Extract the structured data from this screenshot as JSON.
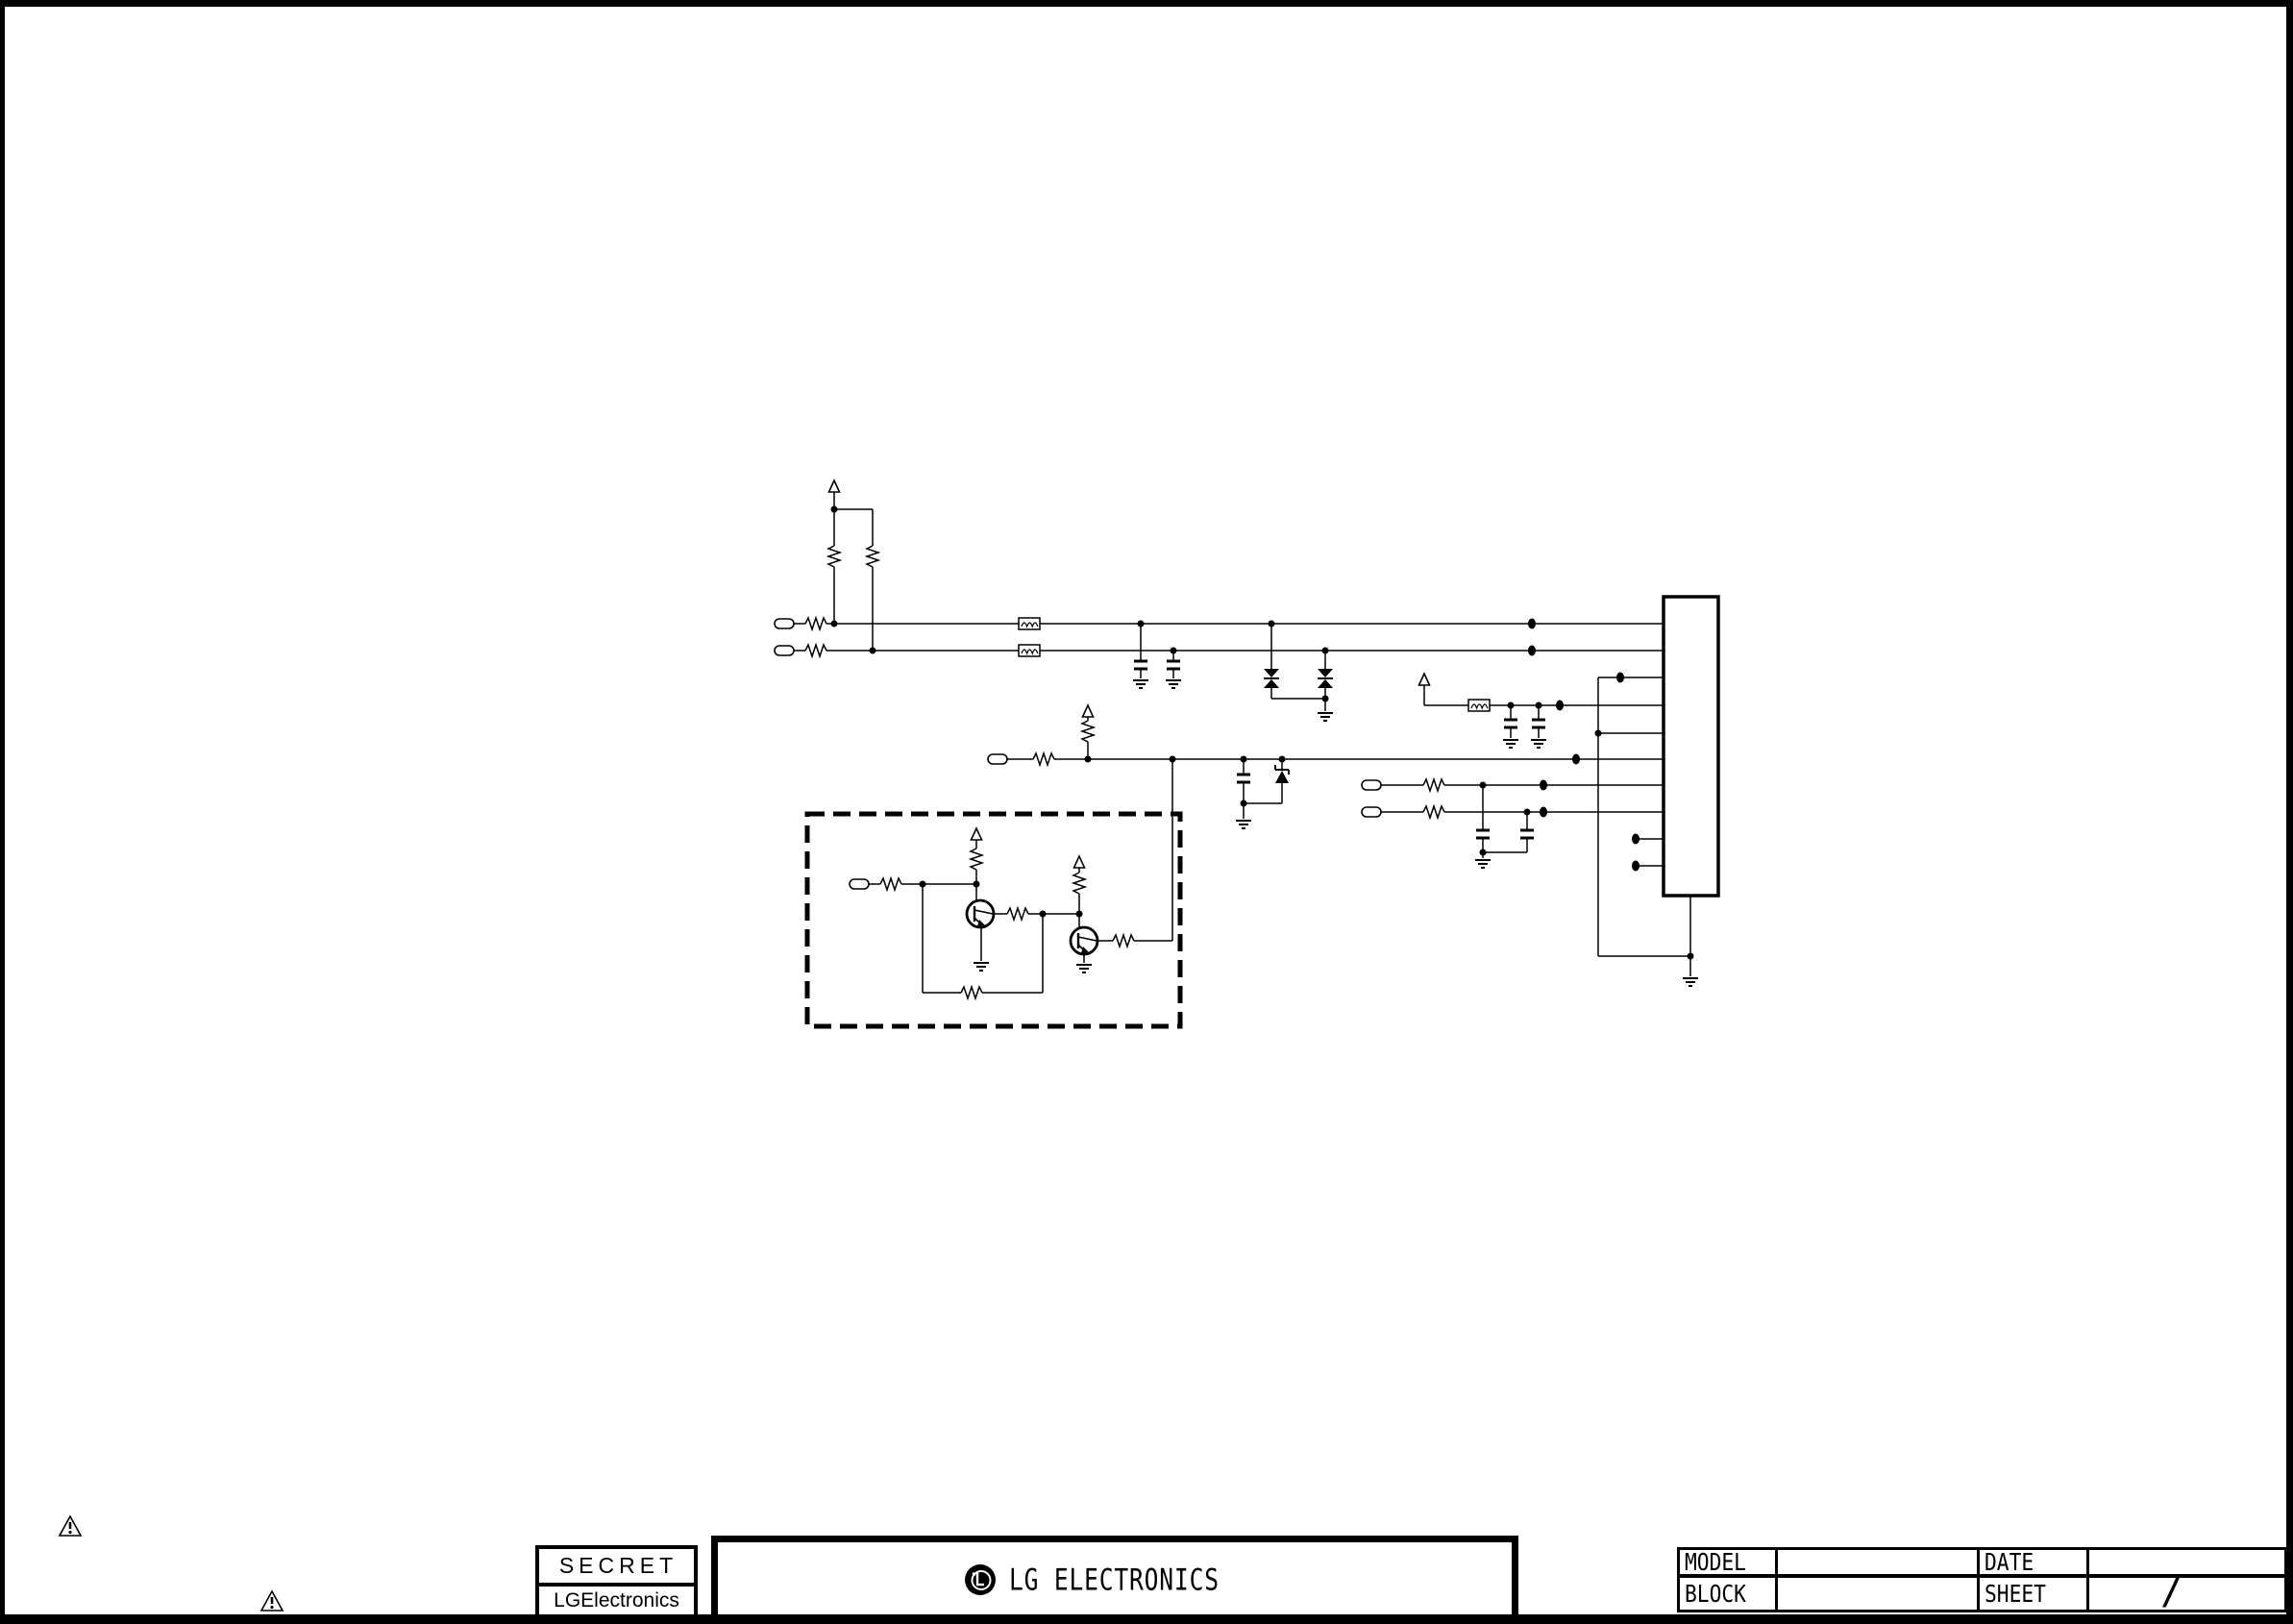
{
  "page": {
    "background": "#ffffff",
    "border_color": "#000000",
    "line_color": "#000000"
  },
  "security_stamp": {
    "classification": "SECRET",
    "company": "LGElectronics"
  },
  "footer_banner": {
    "company_name": "LG ELECTRONICS",
    "logo": "lg-logo"
  },
  "title_block": {
    "model_label": "MODEL",
    "model_value": "",
    "date_label": "DATE",
    "date_value": "",
    "block_label": "BLOCK",
    "block_value": "",
    "sheet_label": "SHEET",
    "sheet_value": "/"
  },
  "icons": {
    "warning": "warning-triangle"
  },
  "schematic": {
    "kind": "circuit-schematic",
    "ic": "main-ic-block",
    "regions": {
      "dashed_box": "transistor-detail"
    },
    "symbols": [
      "connector-port",
      "resistor",
      "ferrite-bead",
      "capacitor",
      "tvs-diode",
      "zener-diode",
      "npn-transistor",
      "ground",
      "power-rail-arrow"
    ]
  }
}
